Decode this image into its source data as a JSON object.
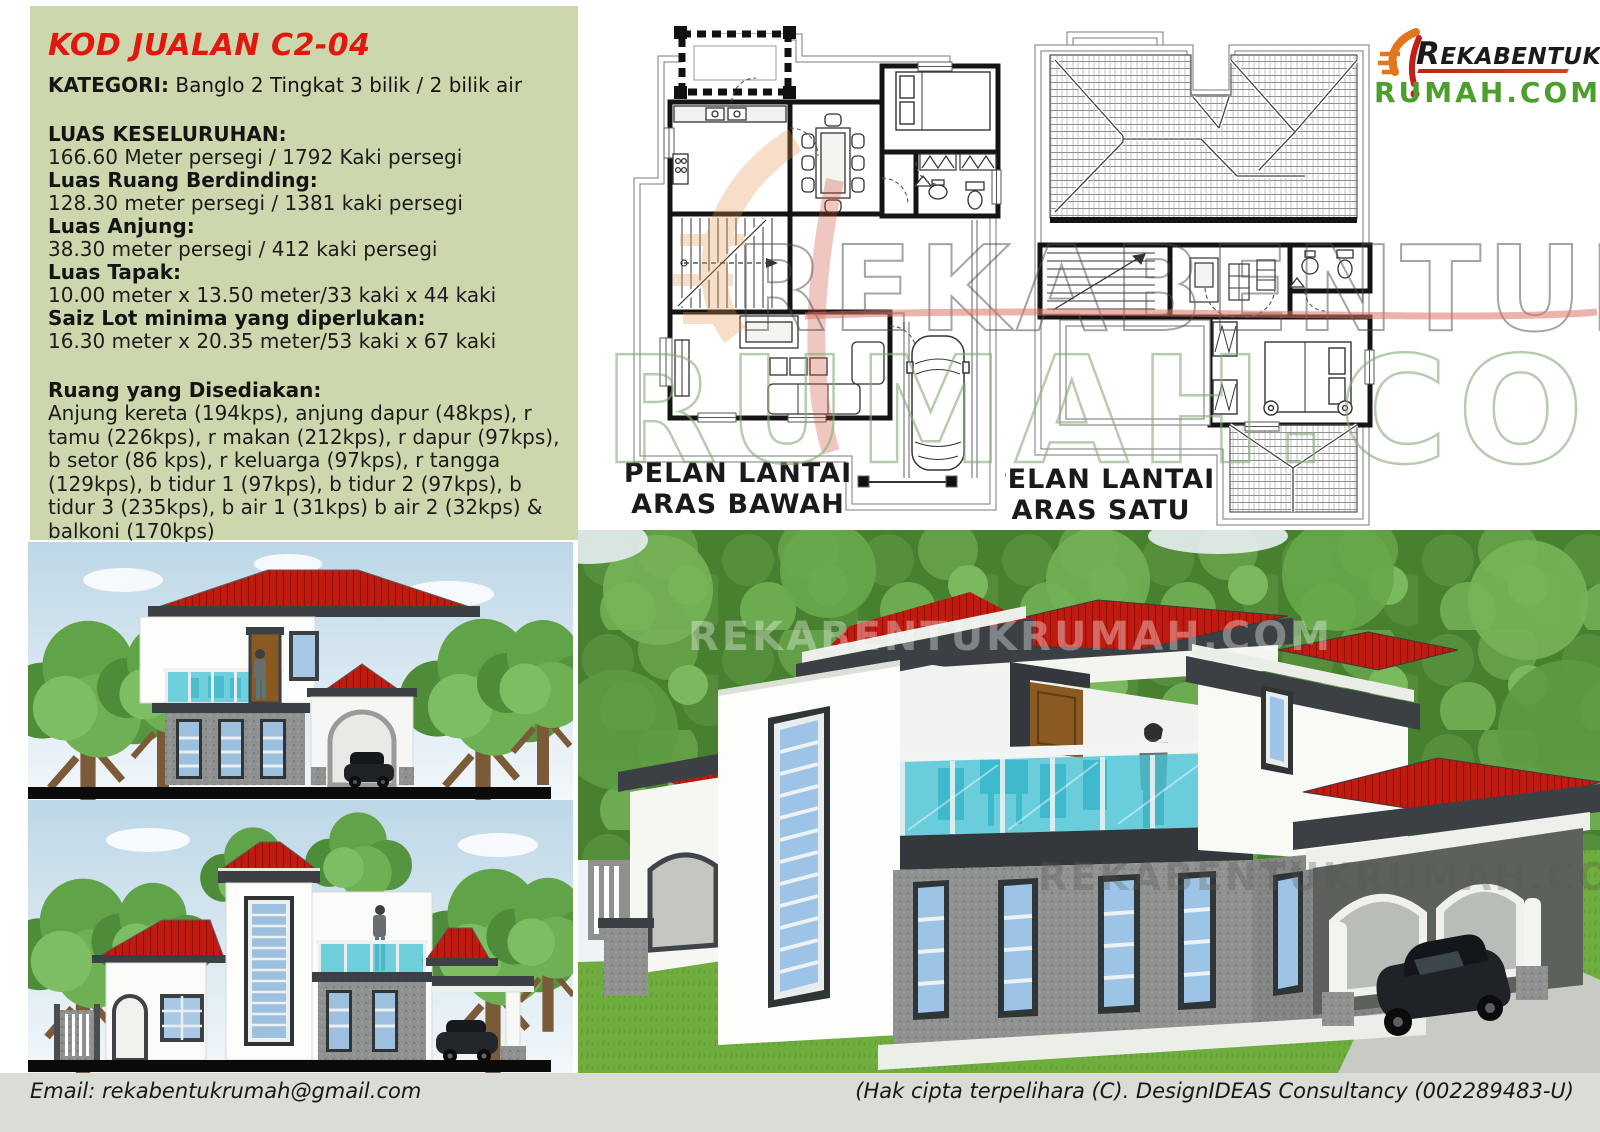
{
  "panel": {
    "title": "KOD JUALAN C2-04",
    "kategori": {
      "label": "KATEGORI:",
      "value": " Banglo 2 Tingkat 3 bilik / 2 bilik air"
    },
    "specs": [
      {
        "label": "LUAS KESELURUHAN:",
        "value": "166.60 Meter persegi / 1792 Kaki persegi"
      },
      {
        "label": "Luas Ruang Berdinding:",
        "value": "128.30 meter persegi / 1381 kaki persegi"
      },
      {
        "label": "Luas Anjung:",
        "value": "38.30 meter persegi / 412 kaki persegi"
      },
      {
        "label": "Luas Tapak:",
        "value": "10.00 meter x 13.50 meter/33 kaki x 44 kaki"
      },
      {
        "label": "Saiz Lot minima yang diperlukan:",
        "value": "16.30 meter x 20.35 meter/53 kaki x 67 kaki"
      }
    ],
    "ruang": {
      "label": "Ruang yang Disediakan:",
      "value": "Anjung kereta (194kps), anjung dapur (48kps), r tamu (226kps), r makan (212kps), r dapur (97kps), b setor (86 kps), r keluarga (97kps), r tangga (129kps), b tidur 1 (97kps), b tidur 2 (97kps), b tidur 3 (235kps), b air 1 (31kps) b air 2 (32kps) & balkoni (170kps)"
    }
  },
  "plans": {
    "ground": {
      "label_line1": "PELAN LANTAI",
      "label_line2": "ARAS BAWAH"
    },
    "first": {
      "label_line1": "PELAN LANTAI",
      "label_line2": "ARAS SATU"
    }
  },
  "logo": {
    "brand_top": "REKABENTUK",
    "brand_bottom": "RUMAH.COM"
  },
  "watermark": {
    "plan_top": "REKABENTUK",
    "plan_bottom": "RUMAH.COM",
    "render_text": "REKABENTUKRUMAH.COM"
  },
  "footer": {
    "email": "Email: rekabentukrumah@gmail.com",
    "copyright": "(Hak cipta terpelihara (C). DesignIDEAS Consultancy (002289483-U)"
  },
  "colors": {
    "panel_bg": "#cdd7ad",
    "title_red": "#e0180e",
    "logo_green": "#4c9e2d",
    "roof_red": "#c01b10",
    "trim_charcoal": "#3b4045",
    "glass_teal": "#47c3d6",
    "footer_bg": "#dadcd6"
  }
}
